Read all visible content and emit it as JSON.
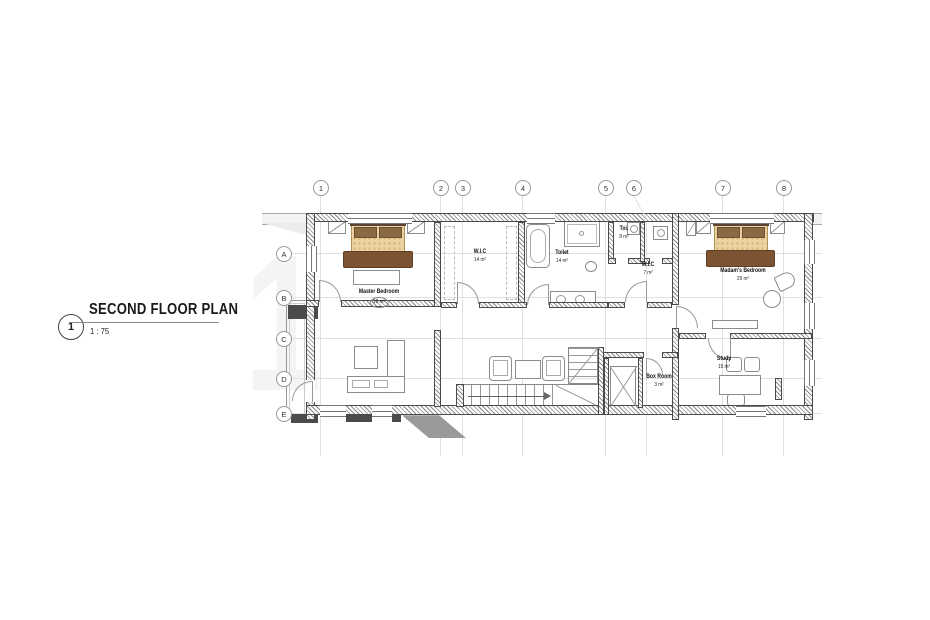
{
  "title_block": {
    "detail_number": "1",
    "title": "SECOND FLOOR PLAN",
    "scale": "1 : 75"
  },
  "watermark_numeral": "1",
  "grid": {
    "columns": [
      "1",
      "2",
      "3",
      "4",
      "5",
      "6",
      "7",
      "8"
    ],
    "rows": [
      "A",
      "B",
      "C",
      "D",
      "E"
    ]
  },
  "rooms": [
    {
      "name": "Master Bedroom",
      "area": "16 m²"
    },
    {
      "name": "W.I.C",
      "area": "14 m²"
    },
    {
      "name": "Toilet",
      "area": "14 m²"
    },
    {
      "name": "Toi.",
      "area": "8 m²"
    },
    {
      "name": "W.I.C",
      "area": "7 m²"
    },
    {
      "name": "Madam's Bedroom",
      "area": "29 m²"
    },
    {
      "name": "Box Room",
      "area": "3 m²"
    },
    {
      "name": "Study",
      "area": "15 m²"
    }
  ],
  "colors": {
    "wall_hatch": "#8a8a8a",
    "wall_edge": "#4a4a4a",
    "dark_fill": "#4b4b4b",
    "bed_mattress": "#eed3a2",
    "bed_pillow": "#8a6a42",
    "bed_blanket": "#7c5433",
    "headboard": "#5a4330",
    "grid_line": "#e0e0e0"
  }
}
